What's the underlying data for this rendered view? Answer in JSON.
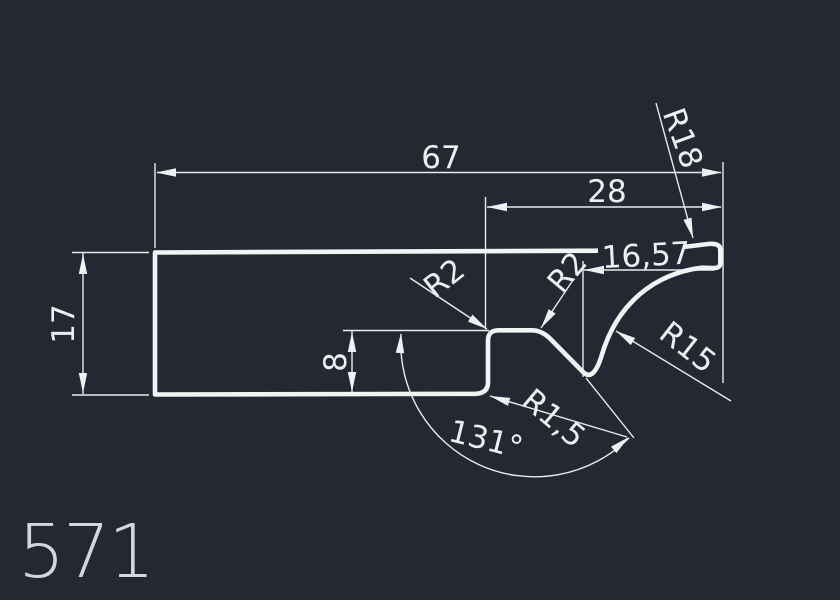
{
  "canvas": {
    "width": 840,
    "height": 600,
    "background_color": "#232833",
    "line_color": "#eef0f2",
    "sheet_label_color": "#d3d6da"
  },
  "drawing": {
    "type": "cad-profile-cross-section",
    "sheet_number": "571",
    "dimensions": {
      "total_length": "67",
      "right_segment_length": "28",
      "tip_segment_length": "16,57",
      "left_height": "17",
      "step_height": "8",
      "notch_angle": "131°",
      "step_left_radius": "R2",
      "step_right_radius": "R2",
      "bottom_fillet_radius": "R1,5",
      "underside_radius": "R15",
      "tip_radius": "R18"
    }
  }
}
